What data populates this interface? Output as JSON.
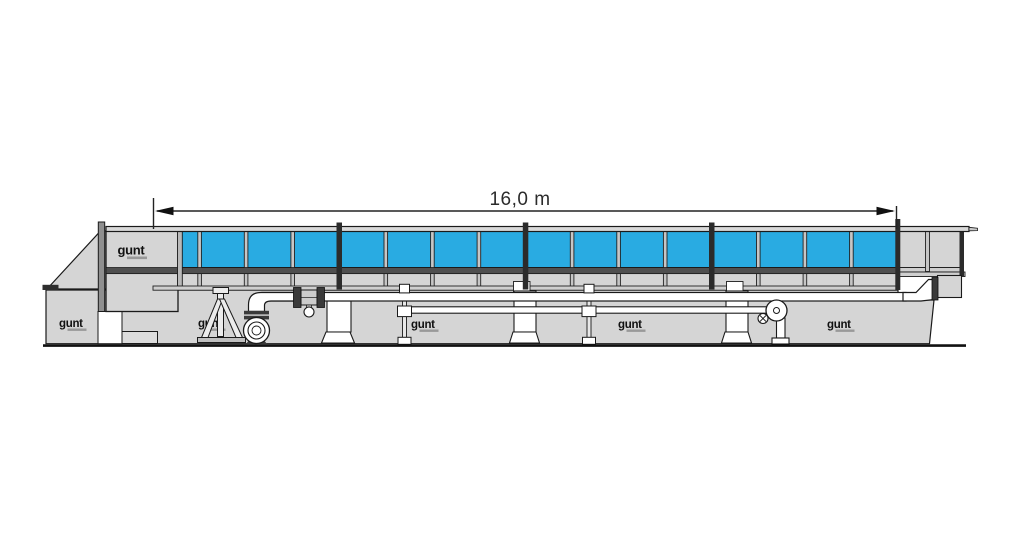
{
  "annotation": {
    "length_label": "16,0 m"
  },
  "brand": {
    "name": "gunt"
  },
  "colors": {
    "water": "#29abe2",
    "structure": "#d5d5d5",
    "rail": "#d9d9d9",
    "dark_frame": "#4f4f4f",
    "outline": "#1a1a1a"
  },
  "flume": {
    "glass_panel_count": 16,
    "module_joints": [
      4,
      8,
      12
    ]
  }
}
